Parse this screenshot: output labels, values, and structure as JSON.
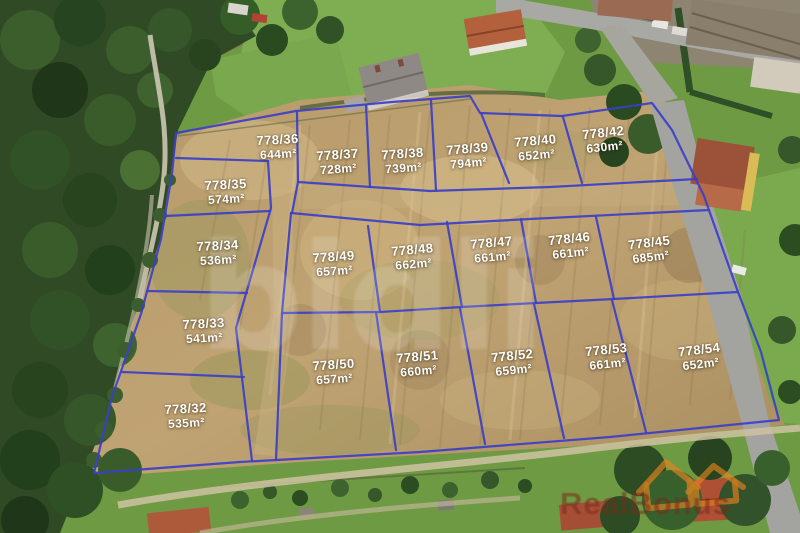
{
  "watermarks": {
    "center_text": "bidli",
    "brand_text": "RealBonus"
  },
  "colors": {
    "boundary_line": "#3b3fc8",
    "label_text": "#ffffff",
    "brand_orange": "#e8831e",
    "brand_dark_red": "#7a2a1a"
  },
  "parcels": [
    {
      "number": "778/36",
      "area": "644m²"
    },
    {
      "number": "778/37",
      "area": "728m²"
    },
    {
      "number": "778/38",
      "area": "739m²"
    },
    {
      "number": "778/39",
      "area": "794m²"
    },
    {
      "number": "778/40",
      "area": "652m²"
    },
    {
      "number": "778/42",
      "area": "630m²"
    },
    {
      "number": "778/35",
      "area": "574m²"
    },
    {
      "number": "778/34",
      "area": "536m²"
    },
    {
      "number": "778/49",
      "area": "657m²"
    },
    {
      "number": "778/48",
      "area": "662m²"
    },
    {
      "number": "778/47",
      "area": "661m²"
    },
    {
      "number": "778/46",
      "area": "661m²"
    },
    {
      "number": "778/45",
      "area": "685m²"
    },
    {
      "number": "778/33",
      "area": "541m²"
    },
    {
      "number": "778/50",
      "area": "657m²"
    },
    {
      "number": "778/51",
      "area": "660m²"
    },
    {
      "number": "778/52",
      "area": "659m²"
    },
    {
      "number": "778/53",
      "area": "661m²"
    },
    {
      "number": "778/54",
      "area": "652m²"
    },
    {
      "number": "778/32",
      "area": "535m²"
    }
  ]
}
